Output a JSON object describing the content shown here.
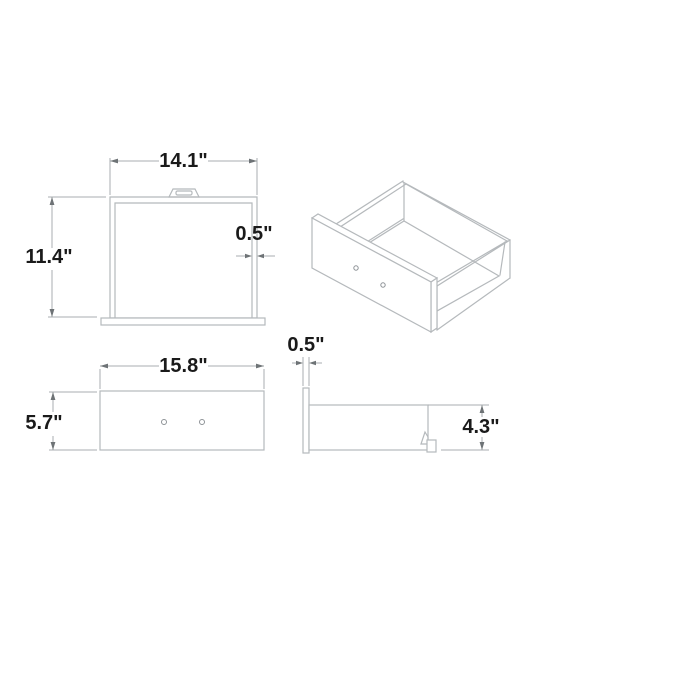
{
  "drawing": {
    "kind": "drawer-dimension-diagram"
  },
  "views": {
    "top": {
      "width_label": "14.1\"",
      "depth_label": "11.4\"",
      "thickness_label": "0.5\""
    },
    "isometric": {},
    "front": {
      "width_label": "15.8\"",
      "height_label": "5.7\""
    },
    "side": {
      "thickness_label": "0.5\"",
      "height_label": "4.3\""
    }
  },
  "colors": {
    "background": "#ffffff",
    "object_line": "#b5b9bc",
    "dim_line": "#a9aeb1",
    "arrow": "#6e7376",
    "hole_line": "#8d9296",
    "label_text": "#1a1a1a"
  }
}
